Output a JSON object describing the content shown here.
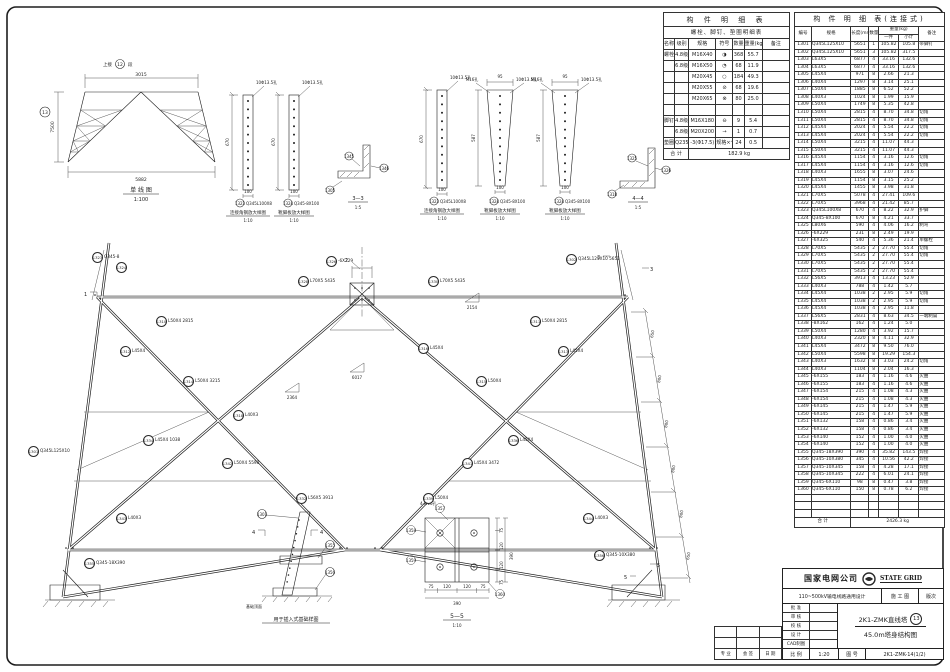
{
  "single_line": {
    "note": "上接",
    "seg": "12",
    "suf": "段",
    "dim_top": "3015",
    "dim_bottom": "5882",
    "dim_left": "7500",
    "circ": "13",
    "title": "单 线 图",
    "scale": "1:100"
  },
  "details": {
    "d1": {
      "no": "1323",
      "spec": "Q345L100X8",
      "note": "10Φ13.5孔",
      "dim": "670",
      "w": "100",
      "name": "连接角钢放大样图",
      "scale": "1:10"
    },
    "d2": {
      "no": "1324",
      "spec": "Q345-8X100",
      "note": "10Φ13.5孔",
      "dim": "670",
      "w": "100",
      "name": "靴脚板放大样图",
      "scale": "1:10"
    },
    "d3": {
      "no": "1323",
      "spec": "Q345L100X8",
      "note": "10Φ13.5孔",
      "dim": "670",
      "w": "100",
      "name": "连接角钢放大样图",
      "scale": "1:10"
    },
    "d4": {
      "no": "1324",
      "spec": "Q345-8X100",
      "note1": "M16孔",
      "note2": "10Φ13.5孔",
      "top": "95",
      "dim": "587",
      "w": "100",
      "name": "靴脚板放大样图",
      "scale": "1:10"
    },
    "d5": {
      "no": "1324",
      "spec": "Q345-8X100",
      "note1": "M16孔",
      "note2": "10Φ13.5孔",
      "top": "95",
      "dim": "587",
      "w": "100",
      "name": "靴脚板放大样图",
      "scale": "1:10"
    },
    "s33": {
      "title": "3—3",
      "scale": "1:5",
      "labels": [
        "1345",
        "1346",
        "1305"
      ]
    },
    "s44": {
      "title": "4—4",
      "scale": "1:5",
      "labels": [
        "1325",
        "1326",
        "1318"
      ]
    },
    "s55": {
      "title": "5—5",
      "scale": "1:10",
      "note": "4-M16孔",
      "dims": [
        "75",
        "120",
        "120",
        "75"
      ],
      "total": "390",
      "labels": [
        "1357",
        "1358",
        "1359",
        "1360"
      ]
    },
    "fnd": {
      "name": "用于插入式基础样图",
      "note": "基础顶面",
      "flag": "4",
      "labels": [
        "1301",
        "1355",
        "1356"
      ]
    }
  },
  "main": {
    "right_dims": [
      "650",
      "800",
      "800",
      "800",
      "800",
      "650"
    ],
    "tri": [
      "2364",
      "6017",
      "2154"
    ],
    "flags": {
      "f1": "1",
      "f2": "2",
      "f3": "3",
      "f5": "5"
    },
    "labels": [
      {
        "no": "1323",
        "t": "Q345-8"
      },
      {
        "no": "1324",
        "t": ""
      },
      {
        "no": "1328",
        "t": "L70X5 5435"
      },
      {
        "no": "1330",
        "t": "L70X5 5435"
      },
      {
        "no": "1310",
        "t": "L50X4 2815"
      },
      {
        "no": "1311",
        "t": "L50X4 2815"
      },
      {
        "no": "1312",
        "t": "L45X4"
      },
      {
        "no": "1313",
        "t": "L45X4"
      },
      {
        "no": "1314",
        "t": "L50X4 3215"
      },
      {
        "no": "1315",
        "t": "L50X4"
      },
      {
        "no": "1318",
        "t": "L40X3"
      },
      {
        "no": "1316",
        "t": "L45X4"
      },
      {
        "no": "1334",
        "t": "L45X4 1038"
      },
      {
        "no": "1336",
        "t": "L45X4"
      },
      {
        "no": "1342",
        "t": "L50X4 5598"
      },
      {
        "no": "1341",
        "t": "L45X4 3472"
      },
      {
        "no": "1301",
        "t": "Q345L125X10"
      },
      {
        "no": "1302",
        "t": "Q345L125X10 5651"
      },
      {
        "no": "1332",
        "t": "L56X5 3913"
      },
      {
        "no": "1339",
        "t": "L50X4"
      },
      {
        "no": "1343",
        "t": "L40X3"
      },
      {
        "no": "1344",
        "t": "L40X3"
      },
      {
        "no": "1326",
        "t": "-6X229"
      },
      {
        "no": "1355",
        "t": "Q345-18X390"
      },
      {
        "no": "1356",
        "t": "Q345-10X380"
      }
    ]
  },
  "tables": {
    "bolt": {
      "title": "构 件 明 细 表",
      "subtitle": "螺栓、脚钉、垫圈明细表",
      "headers": [
        "名称",
        "级别",
        "规格",
        "符号",
        "数量",
        "重量(kg)",
        "备注"
      ],
      "rows": [
        {
          "name": "螺栓",
          "grade": "4.8级",
          "spec": "M16X40",
          "sym": "◑",
          "qty": "368",
          "wt": "55.7",
          "rem": ""
        },
        {
          "name": "",
          "grade": "6.8级",
          "spec": "M16X50",
          "sym": "◔",
          "qty": "68",
          "wt": "11.9",
          "rem": ""
        },
        {
          "name": "",
          "grade": "",
          "spec": "M20X45",
          "sym": "○",
          "qty": "184",
          "wt": "49.3",
          "rem": ""
        },
        {
          "name": "",
          "grade": "",
          "spec": "M20X55",
          "sym": "⊘",
          "qty": "68",
          "wt": "19.6",
          "rem": ""
        },
        {
          "name": "",
          "grade": "",
          "spec": "M20X65",
          "sym": "⊗",
          "qty": "80",
          "wt": "25.0",
          "rem": ""
        },
        {
          "name": "",
          "grade": "",
          "spec": "",
          "sym": "",
          "qty": "",
          "wt": "",
          "rem": ""
        },
        {
          "name": "脚钉",
          "grade": "4.8级",
          "spec": "M16X180",
          "sym": "⊖",
          "qty": "9",
          "wt": "5.4",
          "rem": ""
        },
        {
          "name": "",
          "grade": "6.8级",
          "spec": "M20X200",
          "sym": "→",
          "qty": "1",
          "wt": "0.7",
          "rem": ""
        },
        {
          "name": "垫圈",
          "grade": "Q235",
          "spec": "-3(Φ17.5)",
          "sym": "规格×个数",
          "qty": "24",
          "wt": "0.5",
          "rem": ""
        }
      ],
      "total_label": "合  计",
      "total": "182.9 kg"
    },
    "member": {
      "title": "构 件 明 细 表(连接式)",
      "h": {
        "no": "编号",
        "spec": "规格",
        "len": "长度(mm)",
        "qty": "数量",
        "wt": "重量(kg)",
        "unit": "一件",
        "sub": "小计",
        "rem": "备注"
      },
      "rows": [
        {
          "n": "1301",
          "s": "Q345L125X10",
          "l": "5651",
          "q": "1",
          "u": "105.82",
          "t": "105.8",
          "r": "带脚钉"
        },
        {
          "n": "1302",
          "s": "Q345L125X10",
          "l": "5651",
          "q": "3",
          "u": "105.82",
          "t": "317.5",
          "r": ""
        },
        {
          "n": "1303",
          "s": "L63X5",
          "l": "6877",
          "q": "4",
          "u": "33.16",
          "t": "132.6",
          "r": ""
        },
        {
          "n": "1304",
          "s": "L63X5",
          "l": "6877",
          "q": "4",
          "u": "33.16",
          "t": "132.6",
          "r": ""
        },
        {
          "n": "1305",
          "s": "L45X4",
          "l": "971",
          "q": "8",
          "u": "2.66",
          "t": "21.3",
          "r": ""
        },
        {
          "n": "1306",
          "s": "L40X4",
          "l": "1297",
          "q": "8",
          "u": "3.14",
          "t": "25.1",
          "r": ""
        },
        {
          "n": "1307",
          "s": "L50X4",
          "l": "1885",
          "q": "8",
          "u": "6.52",
          "t": "52.2",
          "r": ""
        },
        {
          "n": "1308",
          "s": "L40X3",
          "l": "1024",
          "q": "8",
          "u": "1.99",
          "t": "15.9",
          "r": ""
        },
        {
          "n": "1309",
          "s": "L50X4",
          "l": "1749",
          "q": "8",
          "u": "5.35",
          "t": "42.8",
          "r": ""
        },
        {
          "n": "1310",
          "s": "L50X4",
          "l": "2815",
          "q": "4",
          "u": "8.70",
          "t": "34.8",
          "r": "切角"
        },
        {
          "n": "1311",
          "s": "L50X4",
          "l": "2815",
          "q": "4",
          "u": "8.70",
          "t": "34.8",
          "r": "切角"
        },
        {
          "n": "1312",
          "s": "L45X4",
          "l": "2024",
          "q": "4",
          "u": "5.54",
          "t": "22.2",
          "r": "切角"
        },
        {
          "n": "1313",
          "s": "L45X4",
          "l": "2024",
          "q": "4",
          "u": "5.54",
          "t": "22.2",
          "r": "切角"
        },
        {
          "n": "1314",
          "s": "L50X4",
          "l": "3215",
          "q": "4",
          "u": "11.07",
          "t": "44.3",
          "r": ""
        },
        {
          "n": "1315",
          "s": "L50X4",
          "l": "3215",
          "q": "4",
          "u": "11.07",
          "t": "44.3",
          "r": ""
        },
        {
          "n": "1316",
          "s": "L45X4",
          "l": "1154",
          "q": "4",
          "u": "3.16",
          "t": "12.6",
          "r": "切角"
        },
        {
          "n": "1317",
          "s": "L45X4",
          "l": "1154",
          "q": "4",
          "u": "3.16",
          "t": "12.6",
          "r": "切角"
        },
        {
          "n": "1318",
          "s": "L40X3",
          "l": "1655",
          "q": "8",
          "u": "3.07",
          "t": "24.6",
          "r": ""
        },
        {
          "n": "1319",
          "s": "L45X4",
          "l": "1154",
          "q": "8",
          "u": "3.15",
          "t": "25.2",
          "r": ""
        },
        {
          "n": "1320",
          "s": "L45X4",
          "l": "1455",
          "q": "8",
          "u": "3.98",
          "t": "31.8",
          "r": ""
        },
        {
          "n": "1321",
          "s": "L70X5",
          "l": "5078",
          "q": "4",
          "u": "27.41",
          "t": "109.6",
          "r": ""
        },
        {
          "n": "1322",
          "s": "L70X5",
          "l": "3968",
          "q": "4",
          "u": "21.42",
          "t": "85.7",
          "r": ""
        },
        {
          "n": "1323",
          "s": "Q345L100X8",
          "l": "670",
          "q": "4",
          "u": "8.22",
          "t": "32.9",
          "r": "护脚"
        },
        {
          "n": "1324",
          "s": "Q345-8X100",
          "l": "670",
          "q": "8",
          "u": "4.21",
          "t": "33.7",
          "r": ""
        },
        {
          "n": "1325",
          "s": "L80X6",
          "l": "590",
          "q": "4",
          "u": "4.06",
          "t": "16.2",
          "r": "制弯"
        },
        {
          "n": "1326",
          "s": "-6X229",
          "l": "231",
          "q": "8",
          "u": "2.49",
          "t": "19.9",
          "r": ""
        },
        {
          "n": "1327",
          "s": "-6X325",
          "l": "540",
          "q": "4",
          "u": "5.36",
          "t": "21.4",
          "r": "单螺栓"
        },
        {
          "n": "1328",
          "s": "L70X5",
          "l": "5435",
          "q": "2",
          "u": "27.70",
          "t": "55.4",
          "r": "切角"
        },
        {
          "n": "1329",
          "s": "L70X5",
          "l": "5435",
          "q": "2",
          "u": "27.70",
          "t": "55.4",
          "r": "切角"
        },
        {
          "n": "1330",
          "s": "L70X5",
          "l": "5435",
          "q": "2",
          "u": "27.70",
          "t": "55.4",
          "r": ""
        },
        {
          "n": "1331",
          "s": "L70X5",
          "l": "5435",
          "q": "2",
          "u": "27.70",
          "t": "55.4",
          "r": ""
        },
        {
          "n": "1332",
          "s": "L56X5",
          "l": "3913",
          "q": "4",
          "u": "13.23",
          "t": "52.9",
          "r": ""
        },
        {
          "n": "1333",
          "s": "L40X3",
          "l": "788",
          "q": "4",
          "u": "1.42",
          "t": "5.7",
          "r": ""
        },
        {
          "n": "1334",
          "s": "L45X4",
          "l": "1038",
          "q": "2",
          "u": "2.95",
          "t": "5.9",
          "r": "切角"
        },
        {
          "n": "1335",
          "s": "L45X4",
          "l": "1038",
          "q": "2",
          "u": "2.95",
          "t": "5.9",
          "r": "切角"
        },
        {
          "n": "1336",
          "s": "L45X4",
          "l": "1038",
          "q": "4",
          "u": "2.95",
          "t": "11.8",
          "r": ""
        },
        {
          "n": "1337",
          "s": "L56X5",
          "l": "2831",
          "q": "4",
          "u": "8.63",
          "t": "34.5",
          "r": "一端制扁"
        },
        {
          "n": "1338",
          "s": "-8X162",
          "l": "162",
          "q": "4",
          "u": "1.24",
          "t": "5.0",
          "r": ""
        },
        {
          "n": "1339",
          "s": "L50X4",
          "l": "1280",
          "q": "4",
          "u": "3.92",
          "t": "15.7",
          "r": ""
        },
        {
          "n": "1340",
          "s": "L40X3",
          "l": "2320",
          "q": "8",
          "u": "4.11",
          "t": "32.9",
          "r": ""
        },
        {
          "n": "1341",
          "s": "L45X4",
          "l": "3472",
          "q": "8",
          "u": "9.50",
          "t": "76.0",
          "r": ""
        },
        {
          "n": "1342",
          "s": "L50X4",
          "l": "5598",
          "q": "8",
          "u": "19.29",
          "t": "154.3",
          "r": ""
        },
        {
          "n": "1343",
          "s": "L40X3",
          "l": "1632",
          "q": "8",
          "u": "3.03",
          "t": "24.2",
          "r": "切角"
        },
        {
          "n": "1344",
          "s": "L40X3",
          "l": "1104",
          "q": "8",
          "u": "2.04",
          "t": "16.3",
          "r": ""
        },
        {
          "n": "1345",
          "s": "-6X155",
          "l": "183",
          "q": "4",
          "u": "1.16",
          "t": "4.6",
          "r": "火曲"
        },
        {
          "n": "1346",
          "s": "-6X155",
          "l": "183",
          "q": "4",
          "u": "1.16",
          "t": "4.6",
          "r": "火曲"
        },
        {
          "n": "1347",
          "s": "-6X154",
          "l": "215",
          "q": "4",
          "u": "1.08",
          "t": "4.3",
          "r": "火曲"
        },
        {
          "n": "1348",
          "s": "-6X154",
          "l": "215",
          "q": "4",
          "u": "1.08",
          "t": "4.3",
          "r": "火曲"
        },
        {
          "n": "1349",
          "s": "-6X145",
          "l": "215",
          "q": "4",
          "u": "1.47",
          "t": "5.9",
          "r": "火曲"
        },
        {
          "n": "1350",
          "s": "-6X145",
          "l": "215",
          "q": "4",
          "u": "1.47",
          "t": "5.9",
          "r": "火曲"
        },
        {
          "n": "1351",
          "s": "-6X132",
          "l": "158",
          "q": "4",
          "u": "0.86",
          "t": "3.4",
          "r": "火曲"
        },
        {
          "n": "1352",
          "s": "-6X132",
          "l": "158",
          "q": "4",
          "u": "0.86",
          "t": "3.4",
          "r": "火曲"
        },
        {
          "n": "1353",
          "s": "-6X140",
          "l": "152",
          "q": "4",
          "u": "1.00",
          "t": "4.0",
          "r": "火曲"
        },
        {
          "n": "1354",
          "s": "-6X140",
          "l": "152",
          "q": "4",
          "u": "1.00",
          "t": "4.0",
          "r": "火曲"
        },
        {
          "n": "1355",
          "s": "Q345-18X390",
          "l": "390",
          "q": "4",
          "u": "35.82",
          "t": "143.5",
          "r": "焊接"
        },
        {
          "n": "1356",
          "s": "Q345-10X380",
          "l": "345",
          "q": "4",
          "u": "10.56",
          "t": "42.2",
          "r": "焊接"
        },
        {
          "n": "1357",
          "s": "Q345-10X345",
          "l": "158",
          "q": "4",
          "u": "4.28",
          "t": "17.1",
          "r": "焊接"
        },
        {
          "n": "1358",
          "s": "Q345-10X345",
          "l": "222",
          "q": "4",
          "u": "6.01",
          "t": "24.1",
          "r": "焊接"
        },
        {
          "n": "1359",
          "s": "Q345-6X110",
          "l": "98",
          "q": "8",
          "u": "0.47",
          "t": "3.8",
          "r": "焊接"
        },
        {
          "n": "1360",
          "s": "Q345-6X110",
          "l": "150",
          "q": "8",
          "u": "0.78",
          "t": "6.2",
          "r": "焊接"
        },
        {
          "n": "",
          "s": "",
          "l": "",
          "q": "",
          "u": "",
          "t": "",
          "r": ""
        },
        {
          "n": "",
          "s": "",
          "l": "",
          "q": "",
          "u": "",
          "t": "",
          "r": ""
        },
        {
          "n": "",
          "s": "",
          "l": "",
          "q": "",
          "u": "",
          "t": "",
          "r": ""
        }
      ],
      "total_label": "合  计",
      "total": "2426.3 kg"
    }
  },
  "title_block": {
    "company": "国家电网公司",
    "company_en": "STATE GRID",
    "project": "110~500kV输电线路通用设计",
    "stage": "施 工 图",
    "rev": "版次",
    "roles": [
      "批 准",
      "审 核",
      "校 核",
      "设 计",
      "CAD制图"
    ],
    "t1": "2K1-ZMK直线塔",
    "t2": "45.0m塔身结构图",
    "circ": "13",
    "scale_label": "比 例",
    "scale": "1:20",
    "no_label": "图 号",
    "no": "2K1-ZMK-14(1/2)",
    "signs": [
      "专 业",
      "会 签",
      "日 期"
    ]
  }
}
